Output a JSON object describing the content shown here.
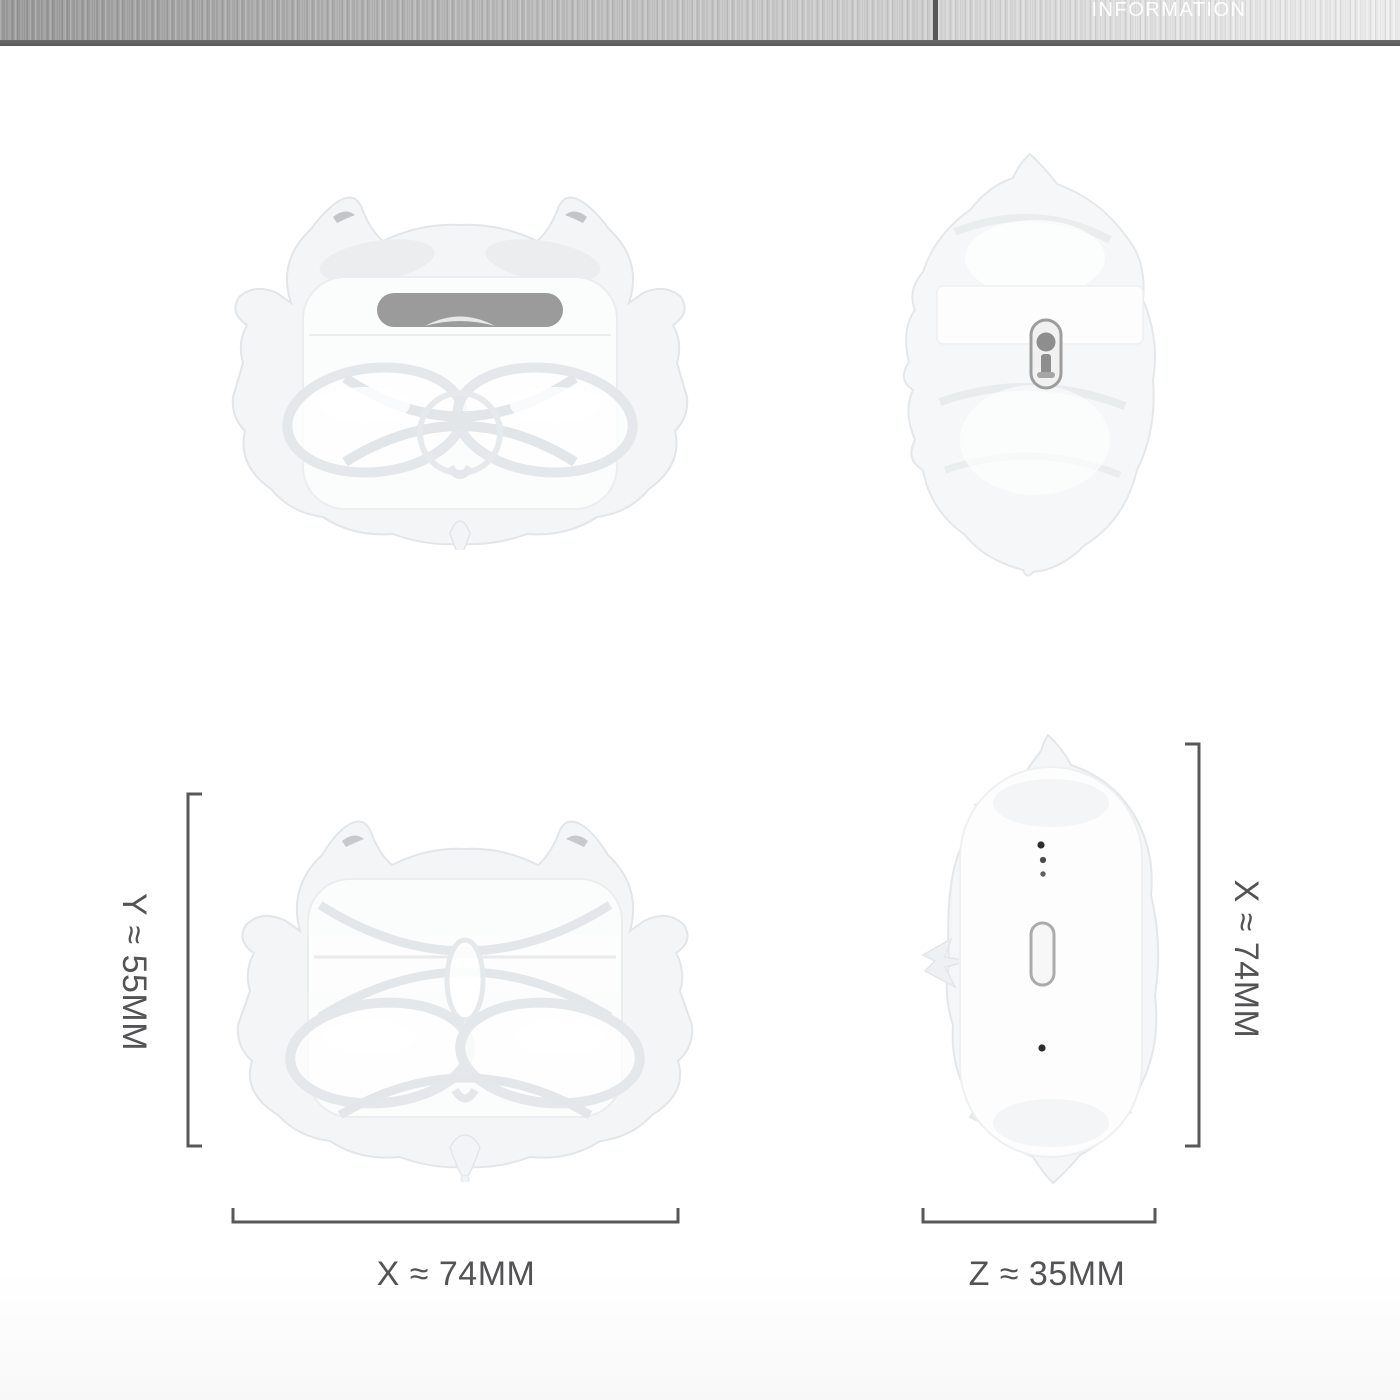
{
  "header": {
    "title": "INFORMATION"
  },
  "dimensions": {
    "height": {
      "axis": "Y",
      "value": "55",
      "unit": "MM",
      "label": "Y ≈ 55MM"
    },
    "width_front": {
      "axis": "X",
      "value": "74",
      "unit": "MM",
      "label": "X ≈ 74MM"
    },
    "width_side": {
      "axis": "X",
      "value": "74",
      "unit": "MM",
      "label": "X ≈ 74MM"
    },
    "depth": {
      "axis": "Z",
      "value": "35",
      "unit": "MM",
      "label": "Z ≈ 35MM"
    }
  },
  "views": [
    {
      "name": "front-open-view",
      "description": "clear sculpted case, lid open, gray hinge slot visible"
    },
    {
      "name": "side-view",
      "description": "clear sculpted case seen from the side with hinge pin detail"
    },
    {
      "name": "front-closed-view",
      "description": "clear sculpted case, front, closed"
    },
    {
      "name": "top-view",
      "description": "white earbuds case inside clear shell: status dots and setup button"
    }
  ],
  "colors": {
    "background": "#ffffff",
    "dimension_lines": "#58585a",
    "label_text": "#535356",
    "header_text": "#ffffff",
    "header_metal_dark": "#9a9a9a",
    "header_metal_light": "#f0f0f0",
    "header_border": "#5a5a5a",
    "hinge_gray": "#9b9b9b",
    "shell_tint": "#f3f5f7",
    "shell_edge": "#e3e6e9"
  }
}
